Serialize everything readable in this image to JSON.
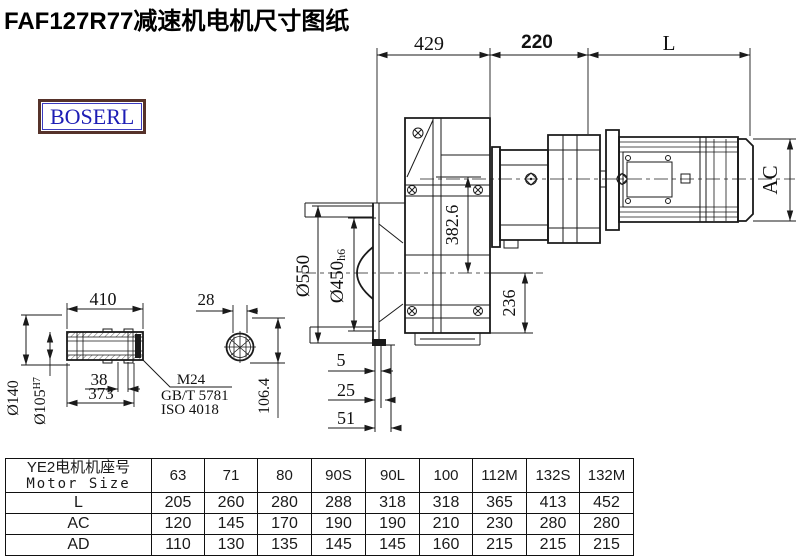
{
  "page": {
    "title": "FAF127R77减速机电机尺寸图纸",
    "brand": "BOSERL"
  },
  "drawing": {
    "dims": {
      "top_left": "429",
      "top_mid": "220",
      "top_right": "L",
      "motor_height": "AC",
      "flange_od": "Ø550",
      "spigot_d": "Ø450",
      "spigot_tol": "h6",
      "axis_height": "382.6",
      "base_height": "236",
      "flange_t1": "5",
      "flange_t2": "25",
      "flange_t3": "51",
      "shaft_len": "410",
      "shaft_body": "373",
      "key_len": "38",
      "key_width": "28",
      "hub_od": "Ø140",
      "bore_d": "Ø105",
      "bore_tol": "H7",
      "height_over_key": "106.4",
      "bolt": "M24",
      "std_gb": "GB/T 5781",
      "std_iso": "ISO 4018"
    }
  },
  "table": {
    "header_cn": "YE2电机机座号",
    "header_en": "Motor Size",
    "columns": [
      "63",
      "71",
      "80",
      "90S",
      "90L",
      "100",
      "112M",
      "132S",
      "132M"
    ],
    "rows": [
      {
        "label": "L",
        "values": [
          "205",
          "260",
          "280",
          "288",
          "318",
          "318",
          "365",
          "413",
          "452"
        ]
      },
      {
        "label": "AC",
        "values": [
          "120",
          "145",
          "170",
          "190",
          "190",
          "210",
          "230",
          "280",
          "280"
        ]
      },
      {
        "label": "AD",
        "values": [
          "110",
          "130",
          "135",
          "145",
          "145",
          "160",
          "215",
          "215",
          "215"
        ]
      }
    ]
  }
}
